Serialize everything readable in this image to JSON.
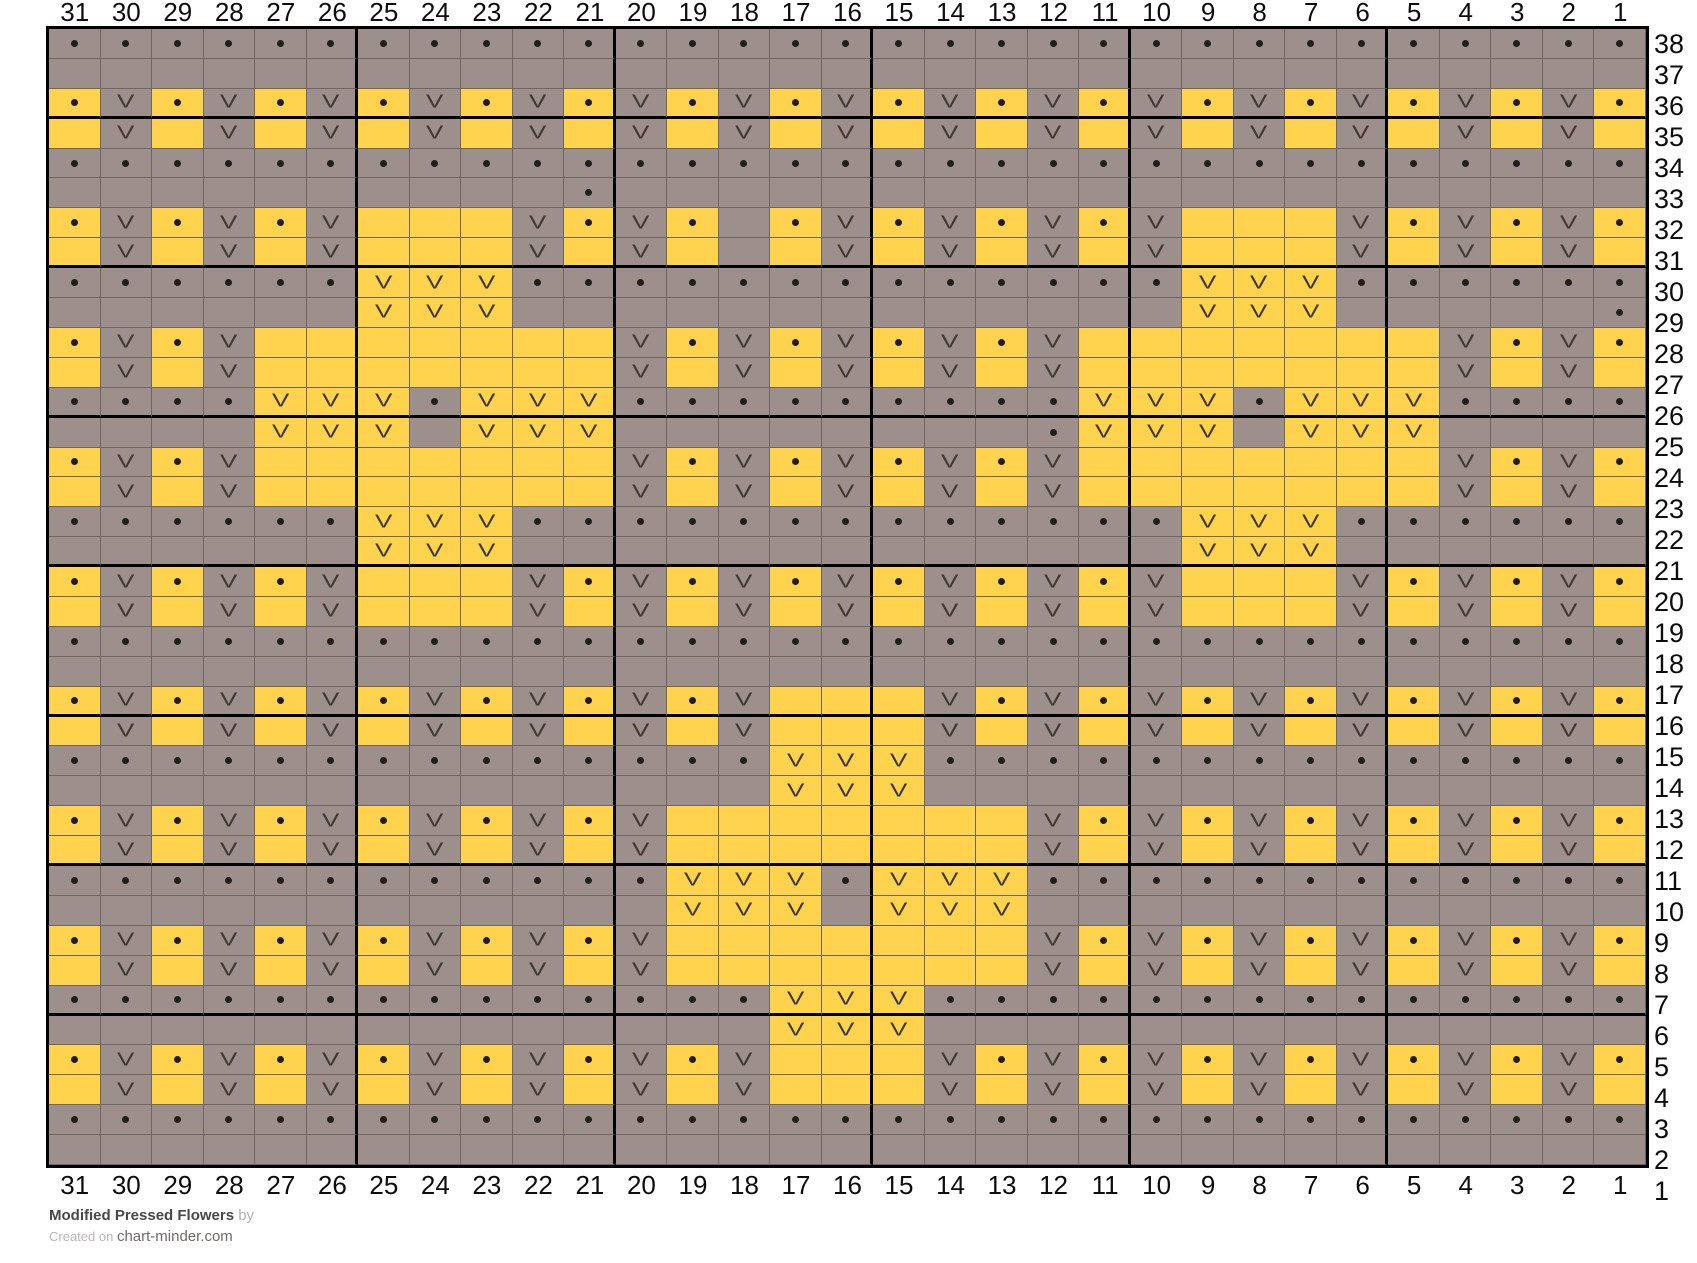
{
  "page": {
    "background": "#ffffff"
  },
  "footer": {
    "title": "Modified Pressed Flowers",
    "by_text": " by",
    "created_prefix": "Created on ",
    "site_link": "chart-minder.com"
  },
  "chart_data": {
    "type": "heatmap",
    "title": "Modified Pressed Flowers",
    "subtitle": "Created on chart-minder.com",
    "grid_size": {
      "columns": 31,
      "rows": 38
    },
    "colors": {
      "yellow": "#FFD34D",
      "gray": "#9C8F8C",
      "grid_line": "#6e6661",
      "repeat_line": "#000000"
    },
    "cell_legend": {
      "d": {
        "bg": "gray",
        "symbol": "dot"
      },
      "g": {
        "bg": "gray",
        "symbol": ""
      },
      "v": {
        "bg": "gray",
        "symbol": "V"
      },
      "D": {
        "bg": "yellow",
        "symbol": "dot"
      },
      "Y": {
        "bg": "yellow",
        "symbol": ""
      },
      "V": {
        "bg": "yellow",
        "symbol": "V"
      }
    },
    "column_labels": [
      31,
      30,
      29,
      28,
      27,
      26,
      25,
      24,
      23,
      22,
      21,
      20,
      19,
      18,
      17,
      16,
      15,
      14,
      13,
      12,
      11,
      10,
      9,
      8,
      7,
      6,
      5,
      4,
      3,
      2,
      1
    ],
    "row_labels": [
      38,
      37,
      36,
      35,
      34,
      33,
      32,
      31,
      30,
      29,
      28,
      27,
      26,
      25,
      24,
      23,
      22,
      21,
      20,
      19,
      18,
      17,
      16,
      15,
      14,
      13,
      12,
      11,
      10,
      9,
      8,
      7,
      6,
      5,
      4,
      3,
      2,
      1
    ],
    "repeat_borders": {
      "bold_after_columns": [
        26,
        21,
        16,
        11,
        6
      ],
      "bold_after_rows": [
        36,
        31,
        26,
        21,
        16,
        11,
        6
      ]
    },
    "rows": [
      {
        "row": 38,
        "cells": "ddddddddddddddddddddddddddddddd"
      },
      {
        "row": 37,
        "cells": "ggggggggggggggggggggggggggggggg"
      },
      {
        "row": 36,
        "cells": "DvDvDvDvDvDvDvDvDvDvDvDvDvDvDvD"
      },
      {
        "row": 35,
        "cells": "YvYvYvYvYvYvYvYvYvYvYvYvYvYvYvY"
      },
      {
        "row": 34,
        "cells": "ddddddddddddddddddddddddddddddd"
      },
      {
        "row": 33,
        "cells": "ggggggggggdgggggggggggggggggggg"
      },
      {
        "row": 32,
        "cells": "DvDvDvYYYvDvDgDvDvDvDvYYYvDvDvD"
      },
      {
        "row": 31,
        "cells": "YvYvYvYYYvYvYgYvYvYvYvYYYvYvYvY"
      },
      {
        "row": 30,
        "cells": "ddddddVVVdddddddddddddVVVdddddd"
      },
      {
        "row": 29,
        "cells": "ggggggVVVgggggggggggggVVVgggggd"
      },
      {
        "row": 28,
        "cells": "DvDvYYYYYYYvDvDvDvDvYYYYYYYvDvD"
      },
      {
        "row": 27,
        "cells": "YvYvYYYYYYYvYvYvYvYvYYYYYYYvYvY"
      },
      {
        "row": 26,
        "cells": "ddddVVVdVVVdddddddddVVVdVVVdddd"
      },
      {
        "row": 25,
        "cells": "ggggVVVgVVVggggggggdVVVgVVVgggg"
      },
      {
        "row": 24,
        "cells": "DvDvYYYYYYYvDvDvDvDvYYYYYYYvDvD"
      },
      {
        "row": 23,
        "cells": "YvYvYYYYYYYvYvYvYvYvYYYYYYYvYvY"
      },
      {
        "row": 22,
        "cells": "ddddddVVVdddddddddddddVVVdddddd"
      },
      {
        "row": 21,
        "cells": "ggggggVVVgggggggggggggVVVgggggg"
      },
      {
        "row": 20,
        "cells": "DvDvDvYYYvDvDvDvDvDvDvYYYvDvDvD"
      },
      {
        "row": 19,
        "cells": "YvYvYvYYYvYvYvYvYvYvYvYYYvYvYvY"
      },
      {
        "row": 18,
        "cells": "ddddddddddddddddddddddddddddddd"
      },
      {
        "row": 17,
        "cells": "ggggggggggggggggggggggggggggggg"
      },
      {
        "row": 16,
        "cells": "DvDvDvDvDvDvDvYYYvDvDvDvDvDvDvD"
      },
      {
        "row": 15,
        "cells": "YvYvYvYvYvYvYvYYYvYvYvYvYvYvYvY"
      },
      {
        "row": 14,
        "cells": "ddddddddddddddVVVdddddddddddddd"
      },
      {
        "row": 13,
        "cells": "ggggggggggggggVVVgggggggggggggg"
      },
      {
        "row": 12,
        "cells": "DvDvDvDvDvDvYYYYYYYvDvDvDvDvDvD"
      },
      {
        "row": 11,
        "cells": "YvYvYvYvYvYvYYYYYYYvYvYvYvYvYvY"
      },
      {
        "row": 10,
        "cells": "ddddddddddddVVVdVVVdddddddddddd"
      },
      {
        "row": 9,
        "cells": "ggggggggggggVVVgVVVgggggggggggg"
      },
      {
        "row": 8,
        "cells": "DvDvDvDvDvDvYYYYYYYvDvDvDvDvDvD"
      },
      {
        "row": 7,
        "cells": "YvYvYvYvYvYvYYYYYYYvYvYvYvYvYvY"
      },
      {
        "row": 6,
        "cells": "ddddddddddddddVVVdddddddddddddd"
      },
      {
        "row": 5,
        "cells": "ggggggggggggggVVVgggggggggggggg"
      },
      {
        "row": 4,
        "cells": "DvDvDvDvDvDvDvYYYvDvDvDvDvDvDvD"
      },
      {
        "row": 3,
        "cells": "YvYvYvYvYvYvYvYYYvYvYvYvYvYvYvY"
      },
      {
        "row": 2,
        "cells": "ddddddddddddddddddddddddddddddd"
      },
      {
        "row": 1,
        "cells": "ggggggggggggggggggggggggggggggg"
      }
    ]
  }
}
